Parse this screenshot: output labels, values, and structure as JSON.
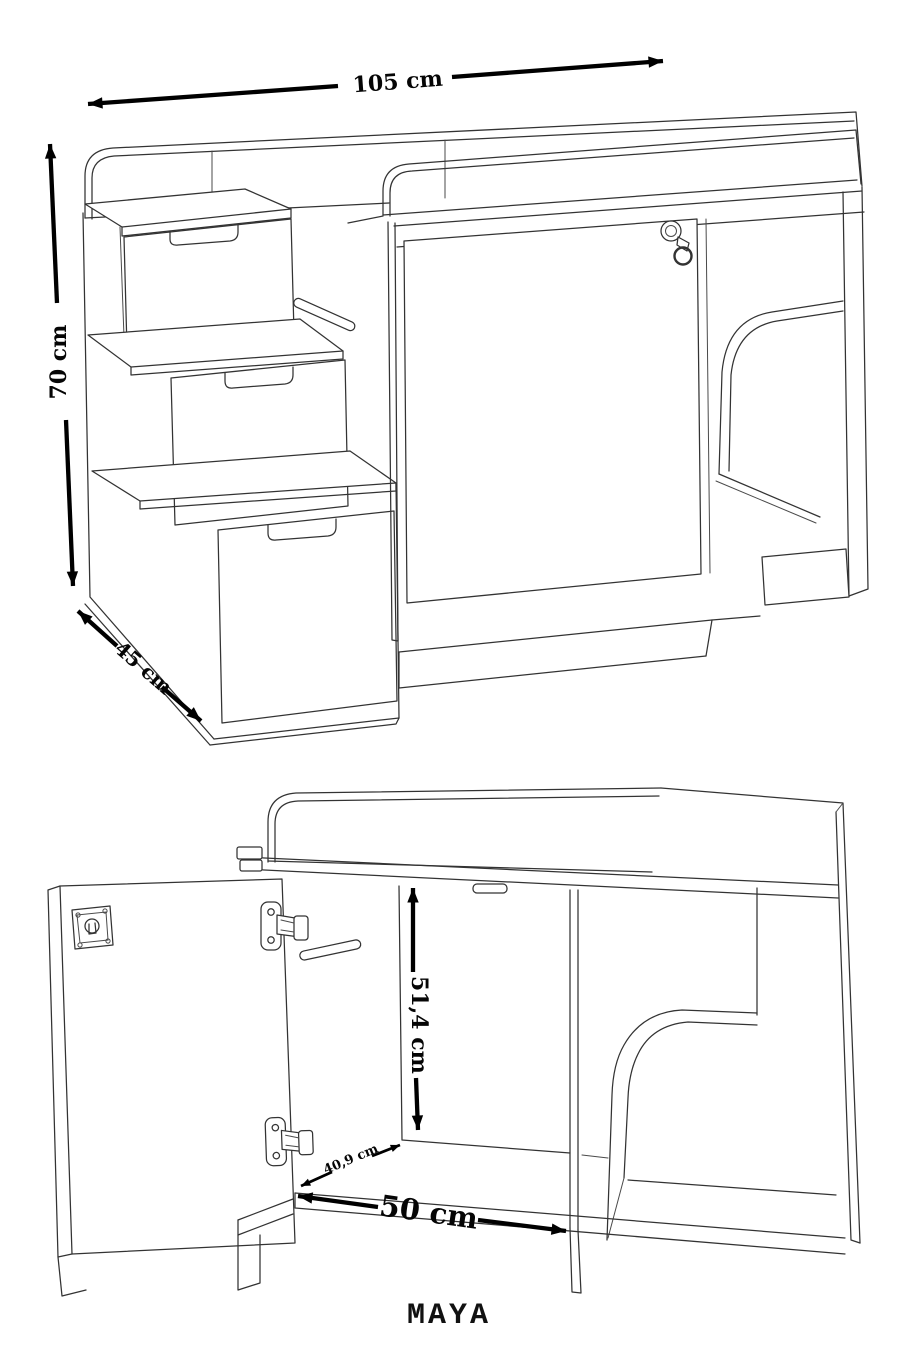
{
  "product": {
    "name": "MAYA"
  },
  "views": {
    "perspective": {
      "dimensions": {
        "width": "105 cm",
        "height": "70 cm",
        "depth": "45 cm"
      }
    },
    "open_front": {
      "dimensions": {
        "interior_height": "51,4 cm",
        "interior_depth": "40,9 cm",
        "interior_width": "50 cm"
      }
    }
  },
  "colors": {
    "background": "#ffffff",
    "drawing_line": "#333333",
    "dimension": "#000000"
  }
}
